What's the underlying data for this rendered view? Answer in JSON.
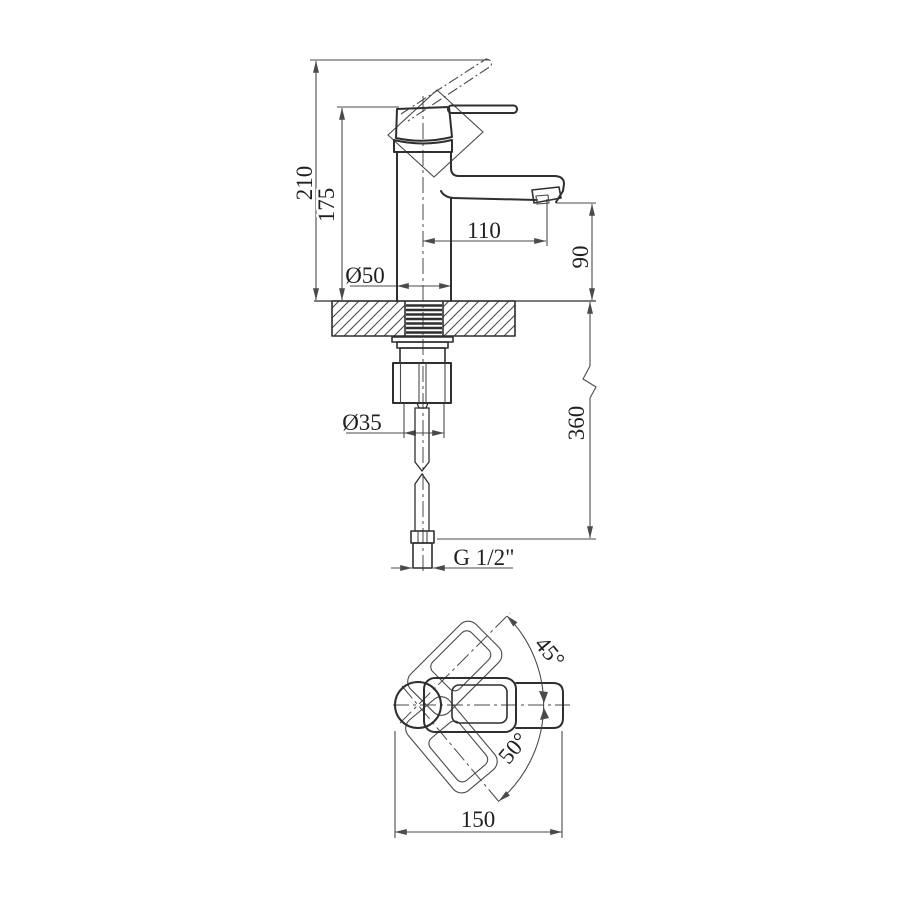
{
  "colors": {
    "line": "#2f2f2f",
    "thin": "#4a4a4a",
    "text": "#1f1f1f",
    "bg": "#ffffff"
  },
  "front_view": {
    "dims": {
      "overall_height": "210",
      "body_height": "175",
      "spout_reach": "110",
      "spout_outlet_height": "90",
      "body_diameter": "Ø50",
      "shank_diameter": "Ø35",
      "supply_hose_drop": "360",
      "connection_thread": "G 1/2\""
    }
  },
  "top_view": {
    "dims": {
      "overall_length": "150",
      "handle_swing_up": "45°",
      "handle_swing_down": "50°"
    }
  }
}
